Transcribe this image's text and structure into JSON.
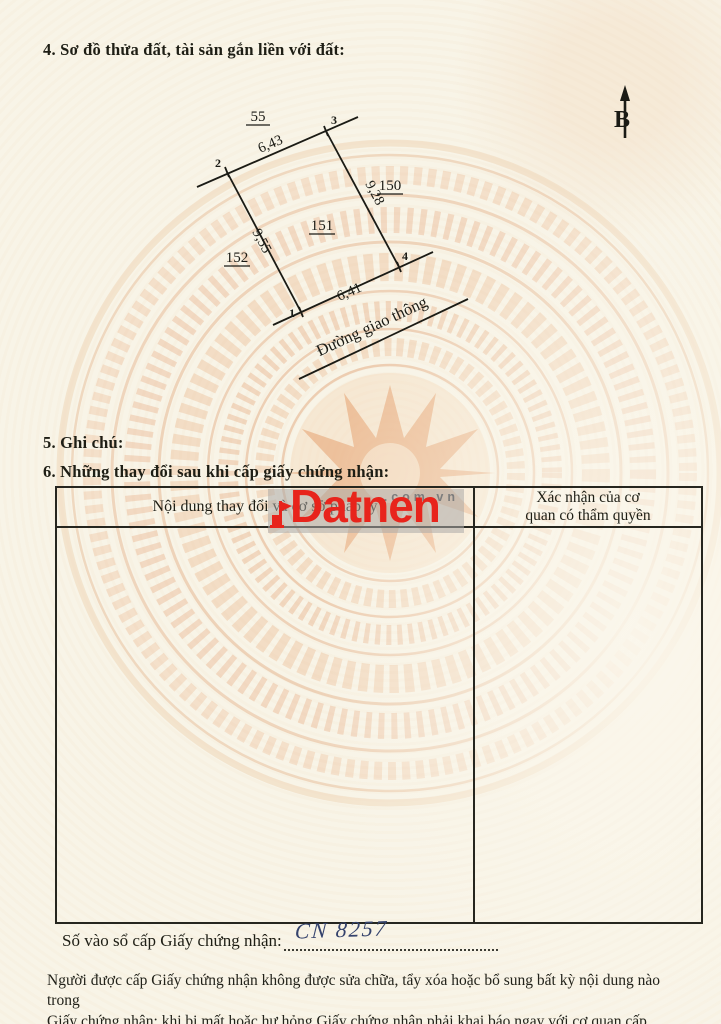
{
  "page": {
    "section4_title": "4. Sơ đồ thửa đất, tài sản gắn liền với đất:",
    "section5_title": "5. Ghi chú:",
    "section6_title": "6. Những thay đổi sau khi cấp giấy chứng nhận:"
  },
  "diagram": {
    "north_label": "B",
    "parcel_number": "151",
    "adjacent_parcels": {
      "top": "55",
      "right": "150",
      "left": "152"
    },
    "vertices": [
      "1",
      "2",
      "3",
      "4"
    ],
    "edge_lengths": {
      "top": "6,43",
      "right": "9,28",
      "left": "9,55",
      "bottom": "6,41"
    },
    "road_label": "Đường giao thông"
  },
  "table": {
    "col1_header": "Nội dung thay đổi và cơ sở pháp lý",
    "col2_header_line1": "Xác nhận của cơ",
    "col2_header_line2": "quan có thẩm quyền"
  },
  "watermark": {
    "brand": "Datnen",
    "suffix": ".com.vn",
    "brand_color": "#e8241c",
    "suffix_color": "#7d7d7d"
  },
  "footer": {
    "entry_label": "Số vào sổ cấp Giấy chứng nhận:",
    "entry_value": "CN 8257",
    "notice_line1": "Người được cấp Giấy chứng nhận không được sửa chữa, tẩy xóa hoặc bổ sung bất kỳ nội dung nào trong",
    "notice_line2": "Giấy chứng nhận; khi bị mất hoặc hư hỏng Giấy chứng nhận phải khai báo ngay với cơ quan cấp Giấy."
  }
}
